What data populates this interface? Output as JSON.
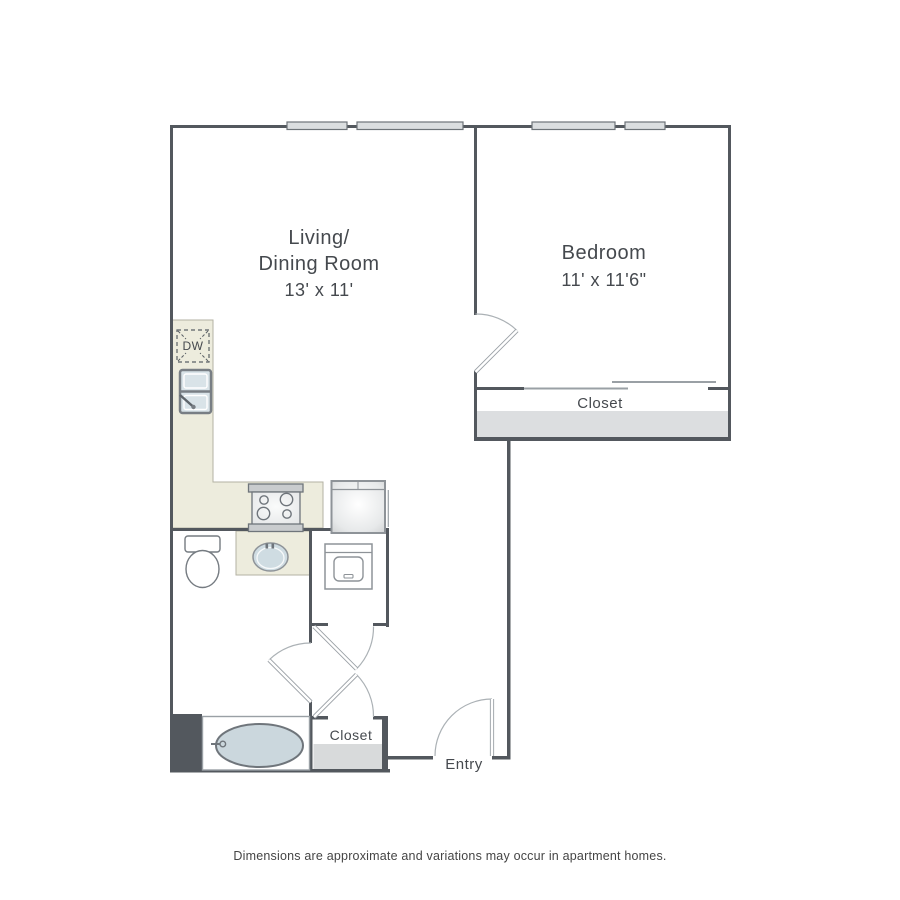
{
  "title": "Apartment floor plan",
  "labels": {
    "living_line1": "Living/",
    "living_line2": "Dining Room",
    "living_dims": "13' x 11'",
    "bedroom": "Bedroom",
    "bedroom_dims": "11' x 11'6\"",
    "bedroom_closet": "Closet",
    "entry_closet": "Closet",
    "entry": "Entry",
    "dishwasher": "DW"
  },
  "disclaimer": "Dimensions are approximate and variations may occur in apartment homes.",
  "fixtures": {
    "kitchen": [
      "dishwasher",
      "double-basin-sink",
      "stove-4-burners",
      "refrigerator"
    ],
    "bathroom": [
      "toilet",
      "vanity-sink",
      "bathtub"
    ],
    "laundry": [
      "washer-dryer"
    ],
    "windows_on_top_wall": 4,
    "doors": [
      "bedroom-door",
      "bathroom-door",
      "laundry-closet-door",
      "entry-closet-door",
      "entry-door"
    ],
    "sliding_doors": [
      "bedroom-closet-sliders"
    ]
  },
  "colors": {
    "wall": "#53585e",
    "line": "#9aa0a5",
    "counter": "#edecdd",
    "water_fixture": "#cbd7dd",
    "closet_shelf": "#dcdee0",
    "window": "#dbdee0",
    "text": "#45494e"
  }
}
